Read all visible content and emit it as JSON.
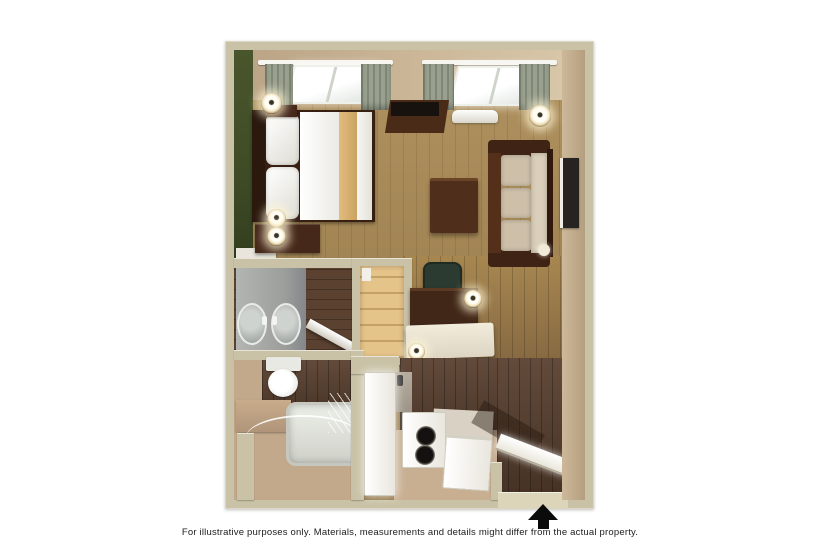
{
  "caption": {
    "text": "For illustrative purposes only.  Materials, measurements and details might differ from the actual property."
  },
  "floor_plan": {
    "kind": "3d-studio-suite-floor-plan",
    "icons": {
      "entrance_arrow": "entrance-arrow-icon"
    },
    "colors": {
      "wall": "#c9c2a6",
      "accent_green": "#3d4a25",
      "floor_light": "#a8874f",
      "floor_dark": "#5a4130",
      "bath_floor": "#c3a98b",
      "closet_floor": "#e5c489",
      "furniture_dark": "#46281a",
      "upholstery": "#cdbfa8",
      "fixture_white": "#f2f1ec",
      "arrow": "#0b0b0b"
    }
  }
}
